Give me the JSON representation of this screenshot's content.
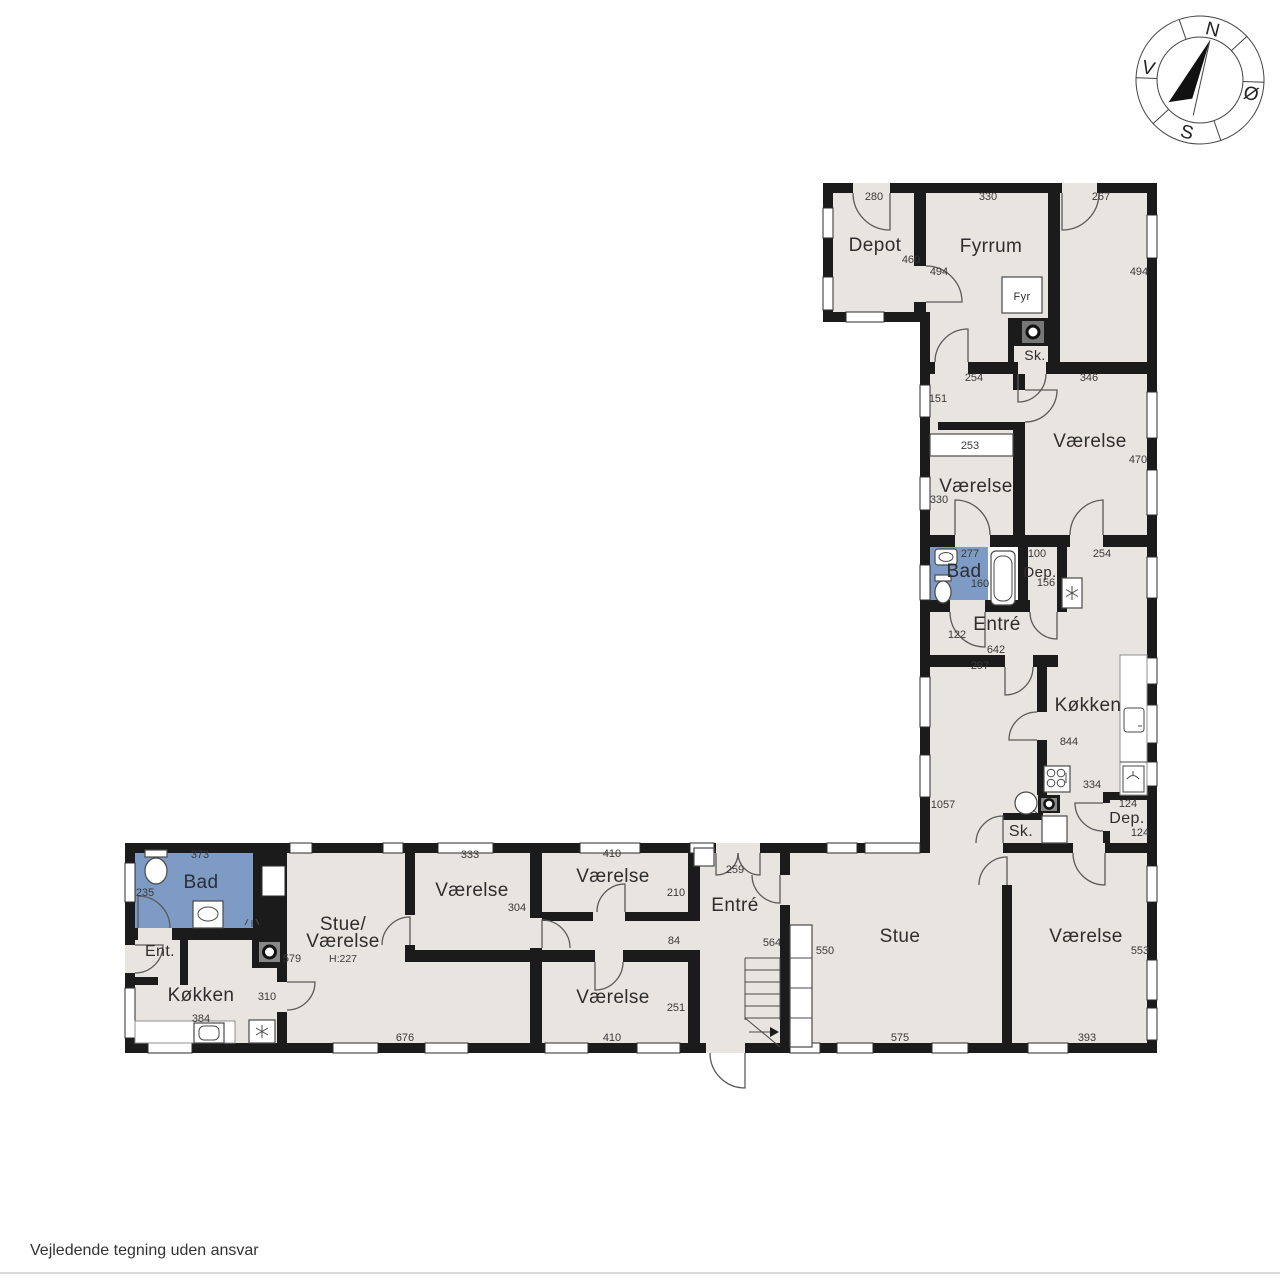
{
  "page": {
    "disclaimer": "Vejledende tegning uden ansvar"
  },
  "compass": {
    "north": "N",
    "east": "Ø",
    "south": "S",
    "west": "V"
  },
  "icons": [
    "compass-rose",
    "toilet",
    "sink",
    "bathtub",
    "wood-stove",
    "freezer-snowflake",
    "cooktop",
    "boiler",
    "dishwasher",
    "stairs-up-arrow"
  ],
  "floor_plan": {
    "room_labels": [
      {
        "text": "Depot",
        "x": 875,
        "y": 251
      },
      {
        "text": "Fyrrum",
        "x": 991,
        "y": 252
      },
      {
        "text": "Fyr",
        "x": 1022,
        "y": 300,
        "size": 11
      },
      {
        "text": "Sk.",
        "x": 1035,
        "y": 360,
        "size": 14
      },
      {
        "text": "Værelse",
        "x": 976,
        "y": 492
      },
      {
        "text": "Værelse",
        "x": 1090,
        "y": 447
      },
      {
        "text": "Bad",
        "x": 964,
        "y": 577
      },
      {
        "text": "Dep.",
        "x": 1040,
        "y": 577,
        "size": 15
      },
      {
        "text": "Entré",
        "x": 997,
        "y": 630
      },
      {
        "text": "Køkken",
        "x": 1088,
        "y": 711
      },
      {
        "text": "Sk.",
        "x": 1021,
        "y": 836,
        "size": 16
      },
      {
        "text": "Dep.",
        "x": 1127,
        "y": 823,
        "size": 16
      },
      {
        "text": "Bad",
        "x": 201,
        "y": 888
      },
      {
        "text": "Ent.",
        "x": 160,
        "y": 956,
        "size": 16
      },
      {
        "text": "Køkken",
        "x": 201,
        "y": 1001
      },
      {
        "text": "Stue/",
        "x": 343,
        "y": 930
      },
      {
        "text": "Værelse",
        "x": 343,
        "y": 947
      },
      {
        "text": "Værelse",
        "x": 472,
        "y": 896
      },
      {
        "text": "Værelse",
        "x": 613,
        "y": 882
      },
      {
        "text": "Værelse",
        "x": 613,
        "y": 1003
      },
      {
        "text": "Entré",
        "x": 735,
        "y": 911
      },
      {
        "text": "Stue",
        "x": 900,
        "y": 942
      },
      {
        "text": "Værelse",
        "x": 1086,
        "y": 942
      }
    ],
    "measurements": [
      {
        "text": "280",
        "x": 874,
        "y": 200
      },
      {
        "text": "330",
        "x": 988,
        "y": 200
      },
      {
        "text": "267",
        "x": 1101,
        "y": 200
      },
      {
        "text": "460",
        "x": 911,
        "y": 263
      },
      {
        "text": "494",
        "x": 939,
        "y": 275
      },
      {
        "text": "494",
        "x": 1139,
        "y": 275
      },
      {
        "text": "254",
        "x": 974,
        "y": 381
      },
      {
        "text": "346",
        "x": 1089,
        "y": 381
      },
      {
        "text": "151",
        "x": 938,
        "y": 402
      },
      {
        "text": "253",
        "x": 970,
        "y": 449
      },
      {
        "text": "470",
        "x": 1138,
        "y": 463
      },
      {
        "text": "330",
        "x": 939,
        "y": 503
      },
      {
        "text": "277",
        "x": 970,
        "y": 557
      },
      {
        "text": "100",
        "x": 1037,
        "y": 557
      },
      {
        "text": "254",
        "x": 1102,
        "y": 557
      },
      {
        "text": "160",
        "x": 980,
        "y": 587
      },
      {
        "text": "156",
        "x": 1046,
        "y": 586
      },
      {
        "text": "122",
        "x": 957,
        "y": 638
      },
      {
        "text": "642",
        "x": 996,
        "y": 653
      },
      {
        "text": "297",
        "x": 980,
        "y": 669
      },
      {
        "text": "844",
        "x": 1069,
        "y": 745
      },
      {
        "text": "334",
        "x": 1092,
        "y": 788
      },
      {
        "text": "1057",
        "x": 943,
        "y": 808
      },
      {
        "text": "124",
        "x": 1128,
        "y": 807
      },
      {
        "text": "124",
        "x": 1140,
        "y": 836
      },
      {
        "text": "373",
        "x": 200,
        "y": 858
      },
      {
        "text": "235",
        "x": 145,
        "y": 896
      },
      {
        "text": "579",
        "x": 292,
        "y": 962
      },
      {
        "text": "310",
        "x": 267,
        "y": 1000
      },
      {
        "text": "384",
        "x": 201,
        "y": 1022
      },
      {
        "text": "333",
        "x": 470,
        "y": 858
      },
      {
        "text": "304",
        "x": 517,
        "y": 911
      },
      {
        "text": "410",
        "x": 612,
        "y": 857
      },
      {
        "text": "210",
        "x": 676,
        "y": 896
      },
      {
        "text": "84",
        "x": 674,
        "y": 944
      },
      {
        "text": "251",
        "x": 676,
        "y": 1011
      },
      {
        "text": "410",
        "x": 612,
        "y": 1041
      },
      {
        "text": "676",
        "x": 405,
        "y": 1041
      },
      {
        "text": "259",
        "x": 735,
        "y": 873
      },
      {
        "text": "564",
        "x": 772,
        "y": 946
      },
      {
        "text": "550",
        "x": 825,
        "y": 954
      },
      {
        "text": "575",
        "x": 900,
        "y": 1041
      },
      {
        "text": "393",
        "x": 1087,
        "y": 1041
      },
      {
        "text": "553",
        "x": 1140,
        "y": 954
      },
      {
        "text": "H:227",
        "x": 343,
        "y": 962,
        "size": 10.5
      }
    ]
  }
}
